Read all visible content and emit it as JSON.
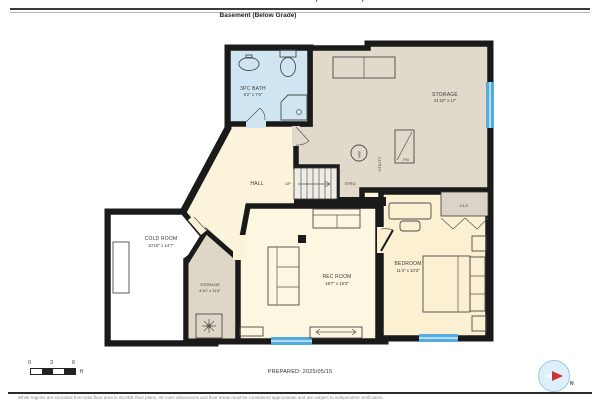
{
  "header": {
    "address": "Canfield Crescent, Ottawa, ON",
    "floor_label": "Basement (Below Grade)"
  },
  "rooms": {
    "bath": {
      "name": "3PC BATH",
      "dims": "6'2\" x 7'6\""
    },
    "storage_main": {
      "name": "STORAGE",
      "dims": "21'10\" x 17'"
    },
    "utility": {
      "name": "UTILITY"
    },
    "hall": {
      "name": "HALL"
    },
    "stairs": {
      "up": "UP",
      "strg": "STRG"
    },
    "cold_room": {
      "name": "COLD ROOM",
      "dims": "10'10\" x 14'7\""
    },
    "storage_small": {
      "name": "STORAGE",
      "dims": "4'10\" x 11'6\""
    },
    "rec_room": {
      "name": "REC ROOM",
      "dims": "18'7\" x 15'3\""
    },
    "bedroom": {
      "name": "BEDROOM",
      "dims": "11'4\" x 10'3\""
    },
    "closet": {
      "name": "CLO"
    },
    "furnace": "FN",
    "water_heater": "HW"
  },
  "footer": {
    "prepared": "PREPARED: 2025/05/15",
    "disclaimer": "White regions are excluded from total floor area in iGUIDE floor plans. All room dimensions and floor areas must be considered approximate and are subject to independent verification.",
    "scale": {
      "t0": "0",
      "t3": "3",
      "t6": "6",
      "unit": "ft"
    },
    "compass_n": "N"
  },
  "colors": {
    "wall": "#1a1a1a",
    "floor_bath": "#cfe6f2",
    "floor_beige": "#e1d9c9",
    "floor_beige2": "#ded6c6",
    "floor_cream": "#fbf3da",
    "floor_rec": "#fdf6e0",
    "floor_bedroom": "#fbf0d2",
    "floor_white": "#ffffff",
    "floor_closet": "#dbd4c6",
    "stairs_fill": "#f0ede5",
    "window": "#55abdc",
    "window_light": "#aedcf2"
  }
}
